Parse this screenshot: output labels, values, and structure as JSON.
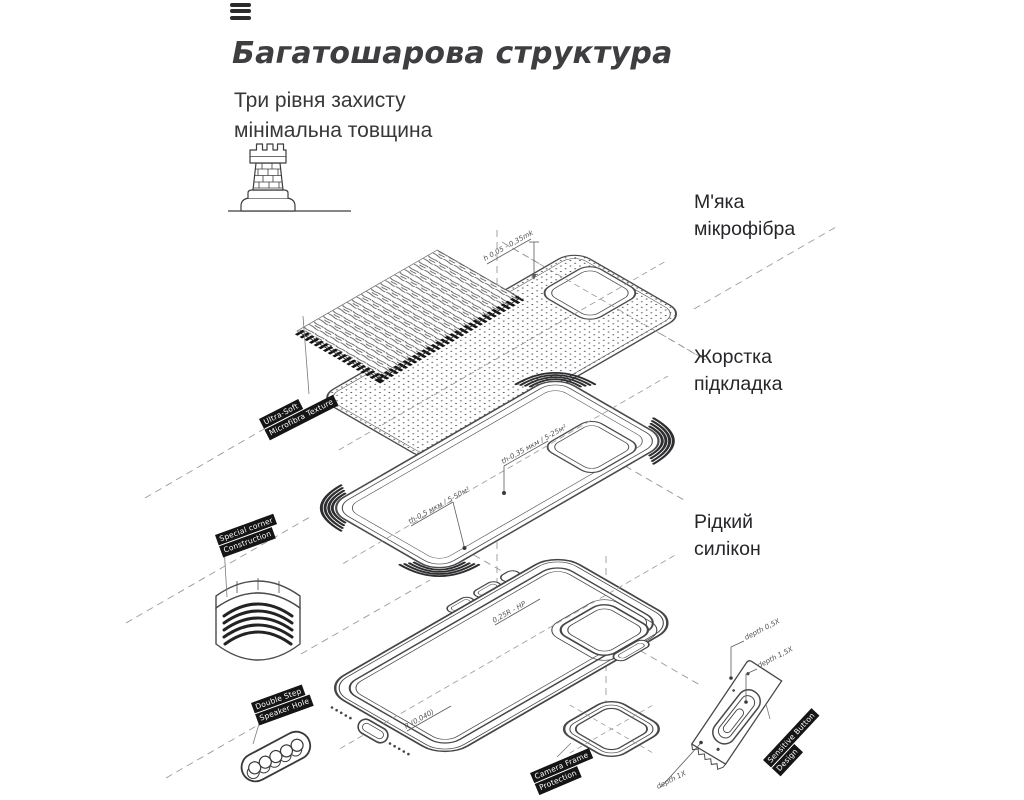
{
  "header": {
    "title": "Багатошарова структура",
    "subtitle_line1": "Три рівня захисту",
    "subtitle_line2": "мінімальна товщина"
  },
  "layer_labels": [
    {
      "line1": "М'яка",
      "line2": "мікрофібра"
    },
    {
      "line1": "Жорстка",
      "line2": "підкладка"
    },
    {
      "line1": "Рідкий",
      "line2": "силікон"
    }
  ],
  "tags": [
    {
      "line1": "Ultra-Soft",
      "line2": "Microfibra Texture"
    },
    {
      "line1": "Special corner",
      "line2": "Construction"
    },
    {
      "line1": "Double Step",
      "line2": "Speaker Hole"
    },
    {
      "line1": "Camera Frame",
      "line2": "Protection"
    },
    {
      "line1": "Sensitive Button",
      "line2": "Design"
    }
  ],
  "annotations": [
    "h 0,05 - 0,35mk",
    "th-0,35 мкм / 5-25м²",
    "th-0,5 мкм / 5-50м²",
    "0,25R - НР",
    "R (0,040)",
    "depth 0,5X",
    "depth 1,5X",
    "depth 1X"
  ],
  "icons": {
    "menu": "menu-icon",
    "tower": "castle-tower-icon"
  },
  "colors": {
    "line": "#4b4b4e",
    "tag_bg": "#151515",
    "tag_text": "#ffffff",
    "title_text": "#3e3e41",
    "body_text": "#2b2b2e"
  }
}
